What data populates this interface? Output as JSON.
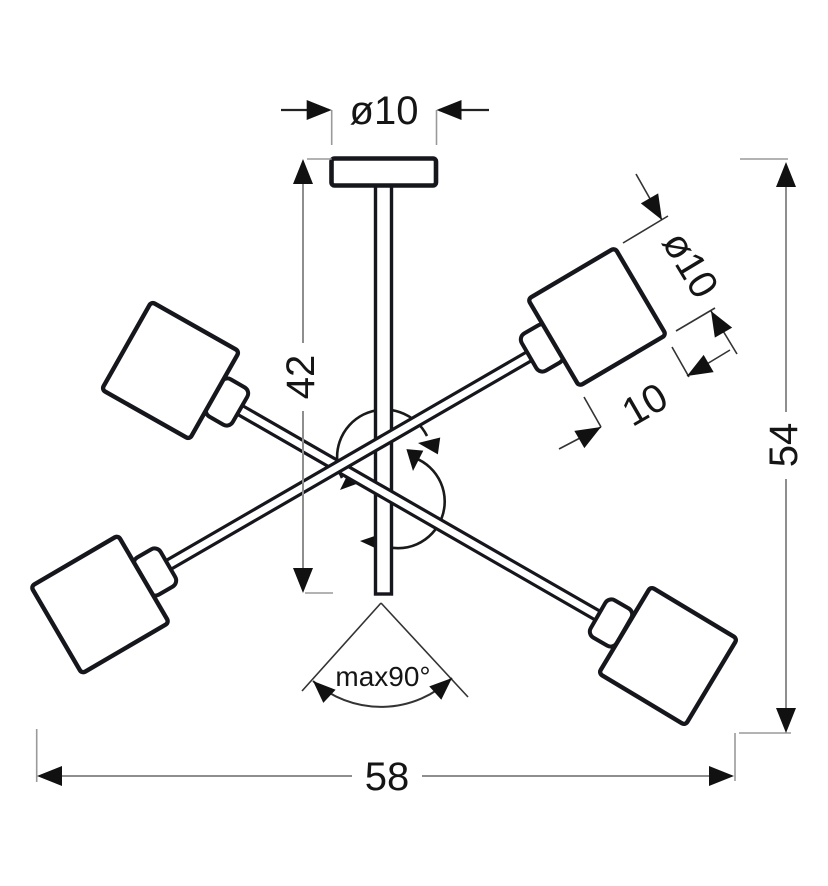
{
  "diagram": {
    "type": "technical-dimension-drawing",
    "background": "#ffffff",
    "line_color": "#16161d",
    "dim_line_color": "#8e8e8e",
    "dimensions": {
      "canopy_diameter": "ø10",
      "rod_drop": "42",
      "shade_diameter": "ø10",
      "shade_height": "10",
      "total_drop": "54",
      "total_width": "58",
      "max_tilt_angle": "max90°"
    }
  }
}
